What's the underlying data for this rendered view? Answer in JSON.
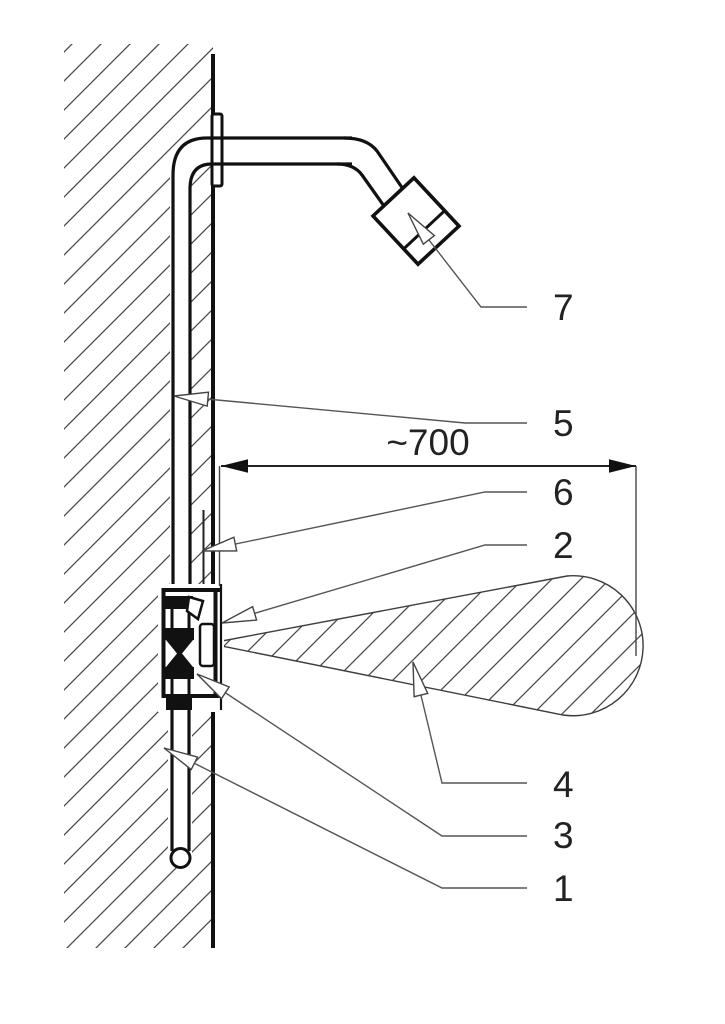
{
  "figure": {
    "description": "Cross-section technical drawing of a wall-mounted shower installation with numbered callouts and one dimension",
    "dimension": {
      "label": "~700"
    },
    "callouts": [
      {
        "label": "7"
      },
      {
        "label": "5"
      },
      {
        "label": "6"
      },
      {
        "label": "2"
      },
      {
        "label": "4"
      },
      {
        "label": "3"
      },
      {
        "label": "1"
      }
    ]
  },
  "colors": {
    "background": "#ffffff",
    "line": "#111111",
    "hatch": "#4a4a4a",
    "leader": "#555555",
    "text": "#222222"
  }
}
